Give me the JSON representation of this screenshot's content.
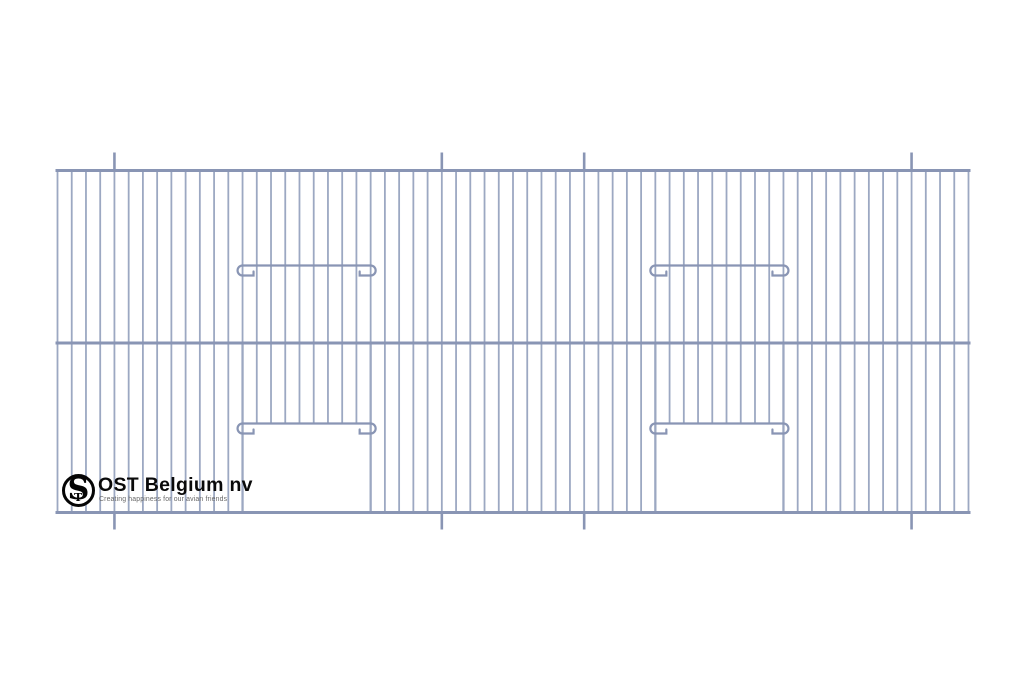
{
  "page": {
    "background": "#ffffff",
    "width": 1024,
    "height": 683
  },
  "branding": {
    "name": "OST Belgium nv",
    "tagline": "Creating happiness for our avian friends",
    "monogram_main": "S",
    "monogram_small": "T",
    "text_color": "#0a0a0a",
    "tagline_color": "#686868",
    "mark_color": "#050505"
  },
  "diagram": {
    "description": "Wire-mesh bird cage front panel with two door openings and hooked slide bars",
    "colors": {
      "wire": "#9ca8c2",
      "frame": "#8995b4"
    },
    "panel": {
      "left": 57.5,
      "right": 968.5,
      "top": 170.5,
      "middle_rail": 343,
      "bottom": 512.5
    },
    "wires": {
      "count": 65
    },
    "wire_width": 1.8,
    "edge_wire_width": 2.3,
    "rail_width": 3,
    "post_width": 2.6,
    "bar_width": 2.2,
    "bar_overhang": 8,
    "hook_drop": 10,
    "posts": {
      "wire_indices": [
        4,
        27,
        37,
        60
      ],
      "extend_above": 18,
      "extend_below": 17
    },
    "doors": [
      {
        "left_wire": 13,
        "right_wire": 22,
        "upper_bar_y": 265.5,
        "lower_bar_y": 423.5
      },
      {
        "left_wire": 42,
        "right_wire": 51,
        "upper_bar_y": 265.5,
        "lower_bar_y": 423.5
      }
    ]
  }
}
